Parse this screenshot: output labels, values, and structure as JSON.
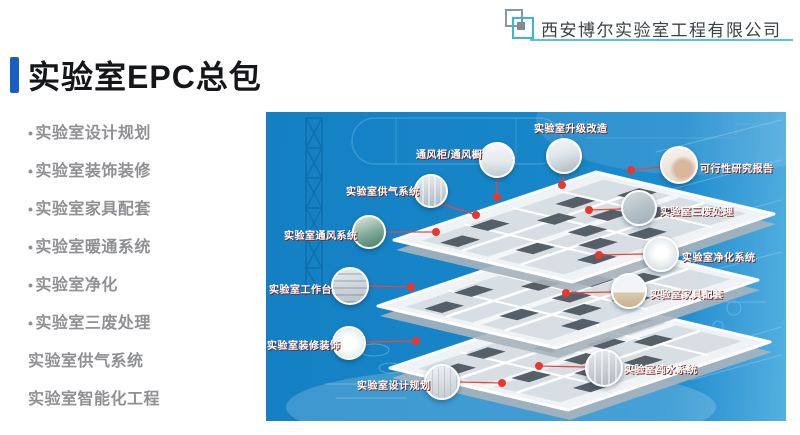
{
  "header": {
    "company_name": "西安博尔实验室工程有限公司"
  },
  "page_title": "实验室EPC总包",
  "services": {
    "bullet": "•",
    "items": [
      {
        "label": "实验室设计规划"
      },
      {
        "label": "实验室装饰装修"
      },
      {
        "label": "实验室家具配套"
      },
      {
        "label": "实验室暖通系统"
      },
      {
        "label": "实验室净化"
      },
      {
        "label": "实验室三废处理"
      },
      {
        "label": "实验室供气系统"
      },
      {
        "label": "实验室智能化工程"
      }
    ]
  },
  "diagram": {
    "colors": {
      "panel_blue": "#1786c7",
      "callout_red": "#e8362c"
    },
    "callouts": [
      {
        "id": "upgrade",
        "label": "实验室升级改造"
      },
      {
        "id": "fume-hood",
        "label": "通风柜/通风橱"
      },
      {
        "id": "gas-supply",
        "label": "实验室供气系统"
      },
      {
        "id": "ventilation",
        "label": "实验室通风系统"
      },
      {
        "id": "feasibility",
        "label": "可行性研究报告"
      },
      {
        "id": "waste-treatment",
        "label": "实验室三废处理"
      },
      {
        "id": "purification",
        "label": "实验室净化系统"
      },
      {
        "id": "furniture",
        "label": "实验室家具配套"
      },
      {
        "id": "workbench",
        "label": "实验室工作台"
      },
      {
        "id": "decoration",
        "label": "实验室装修装饰"
      },
      {
        "id": "design-planning",
        "label": "实验室设计规划"
      },
      {
        "id": "pure-water",
        "label": "实验室纯水系统"
      }
    ]
  }
}
